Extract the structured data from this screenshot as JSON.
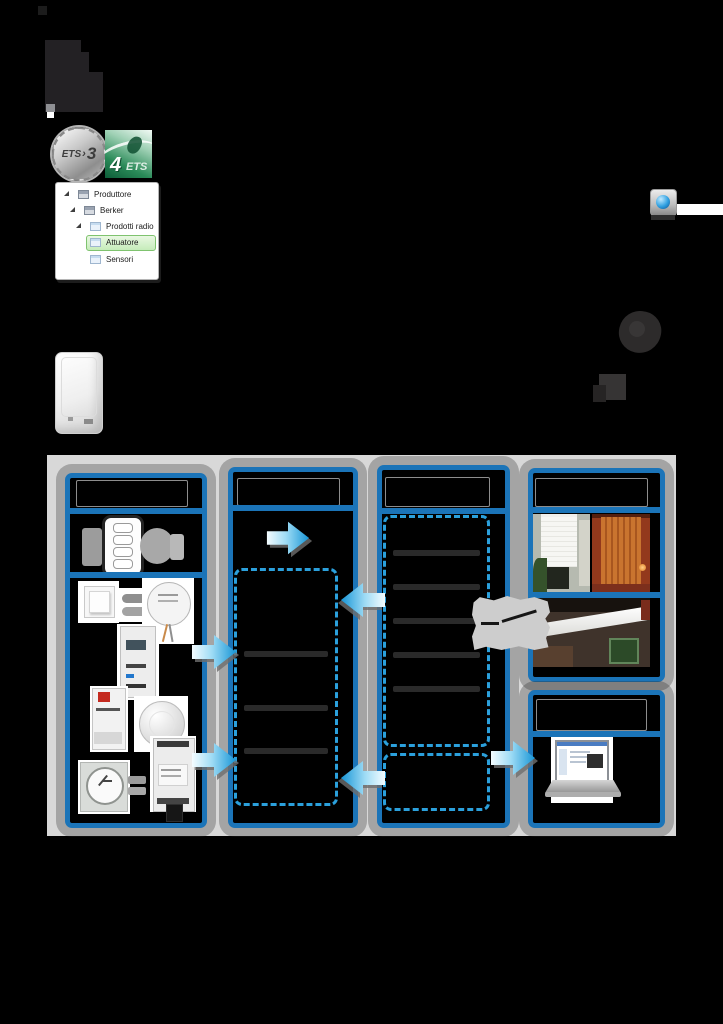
{
  "page": {
    "background_color": "#000000"
  },
  "logos": {
    "ets3": {
      "text": "ETS",
      "chevron": "›",
      "version": "3"
    },
    "ets4": {
      "number": "4",
      "text": "ETS"
    }
  },
  "tree": {
    "items": [
      {
        "label": "Produttore",
        "level": 0,
        "selected": false
      },
      {
        "label": "Berker",
        "level": 1,
        "selected": false
      },
      {
        "label": "Prodotti radio",
        "level": 2,
        "selected": false
      },
      {
        "label": "Attuatore",
        "level": 3,
        "selected": true
      },
      {
        "label": "Sensori",
        "level": 3,
        "selected": false
      }
    ]
  },
  "icons": {
    "tree_expander": "black filled triangle (expanded node)",
    "application_icon": "small grey window glyph",
    "catalog_icon": "small blue page glyph",
    "ets_app_icon": "grey tile with blue sphere",
    "switch_symbol": "electrical switch contact symbol",
    "flow_arrow": "3D block arrow with white-to-blue gradient",
    "radio_waves": "grey wave blobs beside transmitter"
  },
  "colors": {
    "frame_blue": "#1b74b8",
    "dashed_blue": "#2ba0dc",
    "arrow_gradient_start": "#f4fcff",
    "arrow_gradient_end": "#1795d6",
    "diagram_background": "#d8d8d8",
    "selected_item_fill": "#d9f0d0",
    "selected_item_border": "#7fc36f"
  },
  "diagram": {
    "column2_list_row_count": 4,
    "column3_list_row_count": 6,
    "column3_lower_row_count": 1
  }
}
